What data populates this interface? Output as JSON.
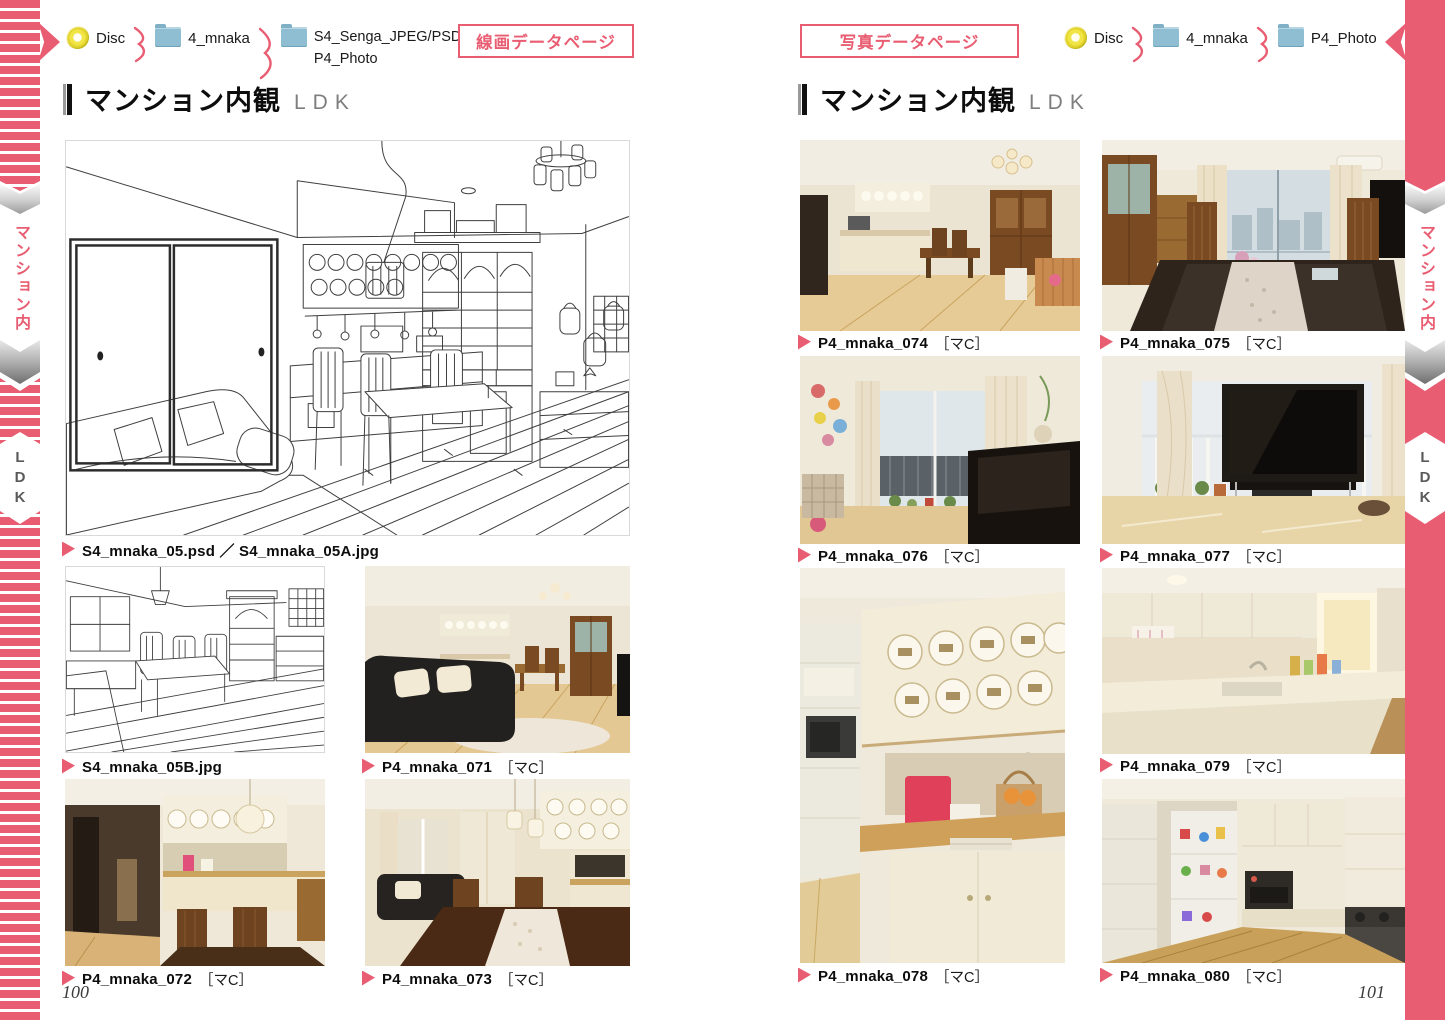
{
  "accent_color": "#e85d72",
  "folder_icon_color": "#8fbdd2",
  "disc_icon_color": "#f0e545",
  "side_tabs": {
    "category": "マンション内",
    "sub": "LDK"
  },
  "left_page": {
    "breadcrumb": {
      "disc_label": "Disc",
      "folder1_label": "4_mnaka",
      "folder2_line1": "S4_Senga_JPEG/PSD",
      "folder2_line2": "P4_Photo"
    },
    "page_type_label": "線画データページ",
    "title": "マンション内観",
    "subtitle": "LDK",
    "captions": {
      "main": "S4_mnaka_05.psd ／ S4_mnaka_05A.jpg",
      "sketch_b": "S4_mnaka_05B.jpg"
    },
    "photos": [
      {
        "name": "P4_mnaka_071",
        "tag": "［マC］"
      },
      {
        "name": "P4_mnaka_072",
        "tag": "［マC］"
      },
      {
        "name": "P4_mnaka_073",
        "tag": "［マC］"
      }
    ],
    "page_number": "100"
  },
  "right_page": {
    "page_type_label": "写真データページ",
    "breadcrumb": {
      "disc_label": "Disc",
      "folder1_label": "4_mnaka",
      "folder2_label": "P4_Photo"
    },
    "title": "マンション内観",
    "subtitle": "LDK",
    "photos": [
      {
        "name": "P4_mnaka_074",
        "tag": "［マC］"
      },
      {
        "name": "P4_mnaka_075",
        "tag": "［マC］"
      },
      {
        "name": "P4_mnaka_076",
        "tag": "［マC］"
      },
      {
        "name": "P4_mnaka_077",
        "tag": "［マC］"
      },
      {
        "name": "P4_mnaka_078",
        "tag": "［マC］"
      },
      {
        "name": "P4_mnaka_079",
        "tag": "［マC］"
      },
      {
        "name": "P4_mnaka_080",
        "tag": "［マC］"
      }
    ],
    "page_number": "101"
  }
}
